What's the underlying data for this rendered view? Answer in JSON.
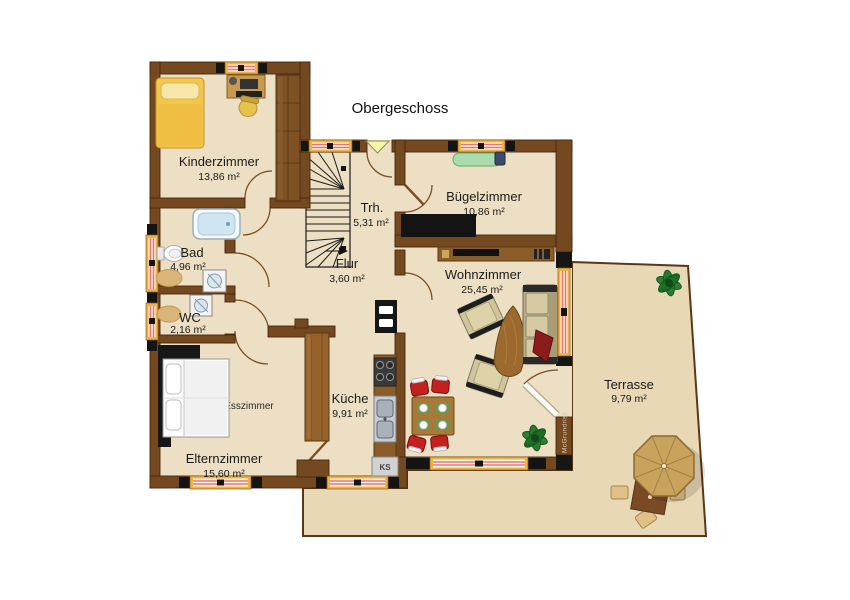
{
  "title": "Obergeschoss",
  "rooms": [
    {
      "name": "Kinderzimmer",
      "area": "13,86 m²"
    },
    {
      "name": "Bad",
      "area": "4,96 m²"
    },
    {
      "name": "WC",
      "area": "2,16 m²"
    },
    {
      "name": "Flur",
      "area": "3,60 m²"
    },
    {
      "name": "Trh.",
      "area": "5,31 m²"
    },
    {
      "name": "Bügelzimmer",
      "area": "10,86 m²"
    },
    {
      "name": "Wohnzimmer",
      "area": "25,45 m²"
    },
    {
      "name": "Esszimmer",
      "area": ""
    },
    {
      "name": "Küche",
      "area": "9,91 m²"
    },
    {
      "name": "Elternzimmer",
      "area": "15,60 m²"
    },
    {
      "name": "Terrasse",
      "area": "9,79 m²"
    }
  ],
  "labels": {
    "fridge": "KS",
    "watermark": "McGrundriss"
  },
  "colors": {
    "wall": "#75491f",
    "wall_dark": "#46290e",
    "floor": "#ecdfc3",
    "terrace": "#e8d8b6",
    "terrace_line": "#5a3817",
    "window_frame": "#edb445",
    "window_bar": "#e07878",
    "wood": "#8a5c2a",
    "black": "#161616",
    "chair_red": "#c32020",
    "plant_green": "#2e7d32",
    "umbrella_tan": "#c9a35c"
  }
}
